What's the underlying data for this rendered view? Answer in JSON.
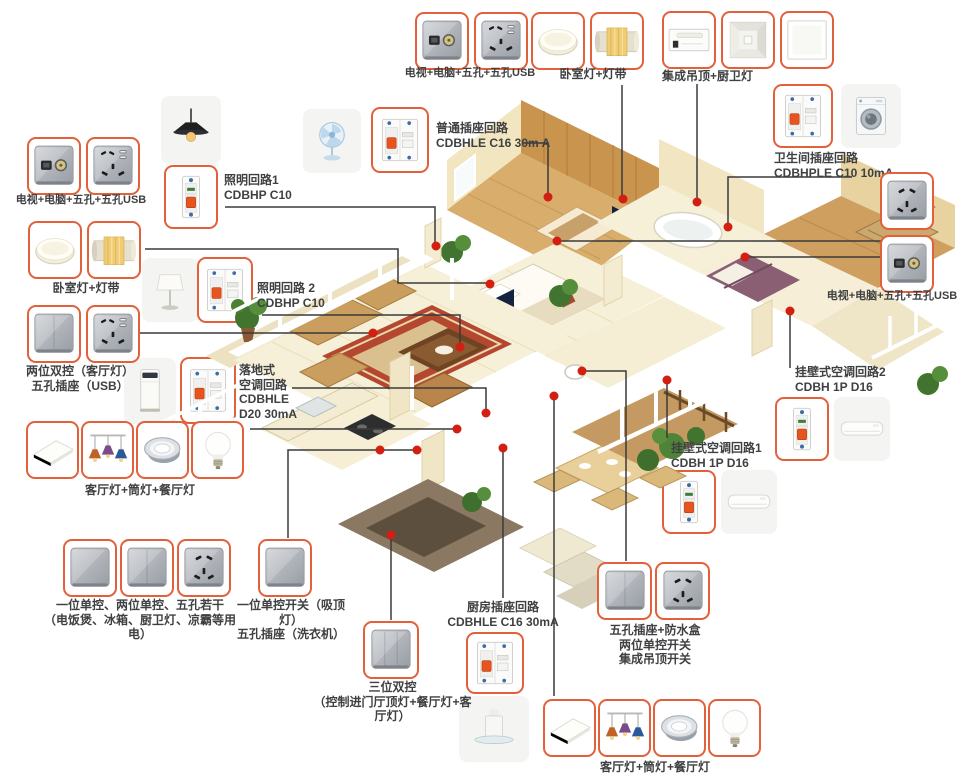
{
  "colors": {
    "callout_border": "#e2603a",
    "connector_line": "#3a3a3a",
    "dot_red": "#d21f12",
    "label_text": "#3f4042",
    "floor_cream": "#f7f0d8",
    "wood_wall": "#c9944e",
    "wood_floor": "#d9ad6b",
    "rug_red": "#b5472e"
  },
  "callouts": {
    "tv_top": {
      "label": "电视+电脑+五孔+五孔USB"
    },
    "bedroom_top": {
      "label": "卧室灯+灯带"
    },
    "ceiling_top": {
      "label": "集成吊顶+厨卫灯"
    },
    "ordinary": {
      "l1": "普通插座回路",
      "l2": "CDBHLE C16 30m A"
    },
    "bath": {
      "l1": "卫生间插座回路",
      "l2": "CDBHPLE C10 10mA"
    },
    "tv_left": {
      "label": "电视+电脑+五孔+五孔USB"
    },
    "light1": {
      "l1": "照明回路1",
      "l2": "CDBHP C10"
    },
    "bedroom_left": {
      "label": "卧室灯+灯带"
    },
    "light2": {
      "l1": "照明回路 2",
      "l2": "CDBHP C10"
    },
    "twogang": {
      "l1": "两位双控（客厅灯）",
      "l2": "五孔插座（USB）"
    },
    "floorac": {
      "l1": "落地式",
      "l2": "空调回路",
      "l3": "CDBHLE",
      "l4": "D20 30mA"
    },
    "living_left": {
      "label": "客厅灯+筒灯+餐厅灯"
    },
    "tv_right": {
      "label": "电视+电脑+五孔+五孔USB"
    },
    "wallac2": {
      "l1": "挂壁式空调回路2",
      "l2": "CDBH 1P D16"
    },
    "wallac1": {
      "l1": "挂壁式空调回路1",
      "l2": "CDBH 1P D16"
    },
    "kitchen_sw": {
      "l1": "一位单控、两位单控、五孔若干",
      "l2": "（电饭煲、冰箱、厨卫灯、凉霸等用电）"
    },
    "single_sw": {
      "l1": "一位单控开关（吸顶灯）",
      "l2": "五孔插座（洗衣机）"
    },
    "threegang": {
      "l1": "三位双控",
      "l2": "（控制进门厅顶灯+餐厅灯+客厅灯）"
    },
    "kitchen_socket": {
      "l1": "厨房插座回路",
      "l2": "CDBHLE C16 30mA"
    },
    "waterproof": {
      "l1": "五孔插座+防水盒",
      "l2": "两位单控开关",
      "l3": "集成吊顶开关"
    },
    "living_bottom": {
      "label": "客厅灯+筒灯+餐厅灯"
    }
  }
}
